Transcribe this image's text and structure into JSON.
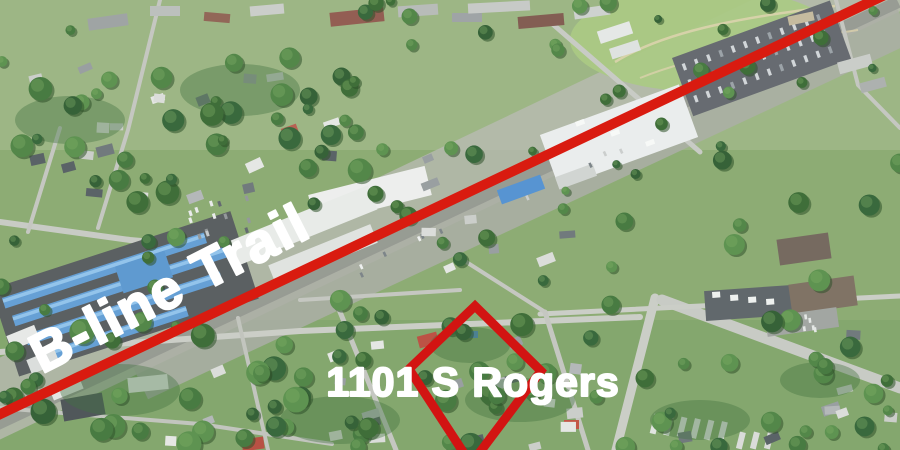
{
  "annotations": {
    "trail_label": "B-line Trail",
    "property_label": "1101 S Rogers",
    "trail_line_color": "#D91B10",
    "boundary_color": "#D21412",
    "label_color": "#FFFFFF"
  }
}
